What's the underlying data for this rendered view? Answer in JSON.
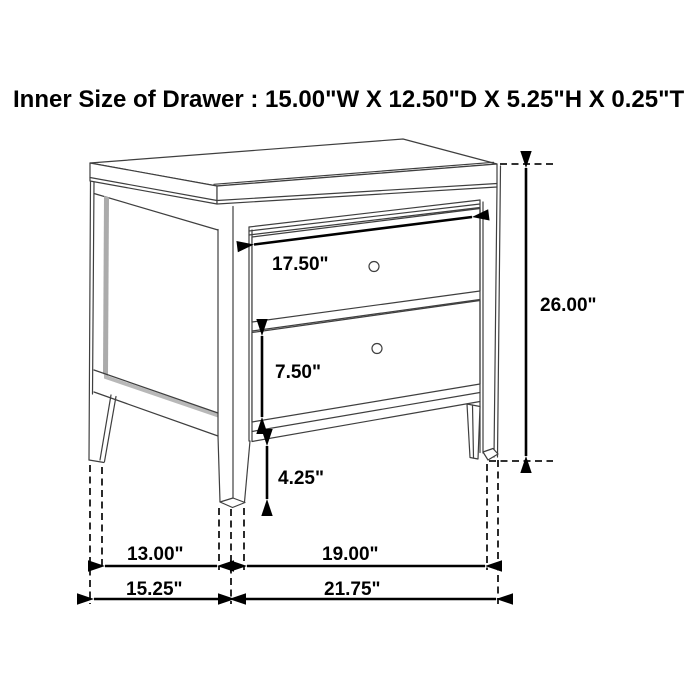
{
  "title": "Inner Size of Drawer : 15.00\"W X 12.50\"D X 5.25\"H X 0.25\"T",
  "inner_drawer_size": {
    "width": "15.00\"",
    "depth": "12.50\"",
    "height": "5.25\"",
    "thickness": "0.25\""
  },
  "figure": {
    "subject": "two-drawer nightstand dimension line drawing",
    "drawer_count": 2,
    "dimensions": {
      "top_drawer_width": {
        "label": "17.50\""
      },
      "overall_height": {
        "label": "26.00\""
      },
      "bottom_drawer_height": {
        "label": "7.50\""
      },
      "leg_height": {
        "label": "4.25\""
      },
      "side_leg_span": {
        "label": "13.00\""
      },
      "overall_depth": {
        "label": "15.25\""
      },
      "front_leg_span": {
        "label": "19.00\""
      },
      "overall_width": {
        "label": "21.75\""
      }
    },
    "colors": {
      "line": "#3f3f3f",
      "dimension": "#000000",
      "panel_shadow": "#ababab",
      "background": "#ffffff"
    }
  }
}
